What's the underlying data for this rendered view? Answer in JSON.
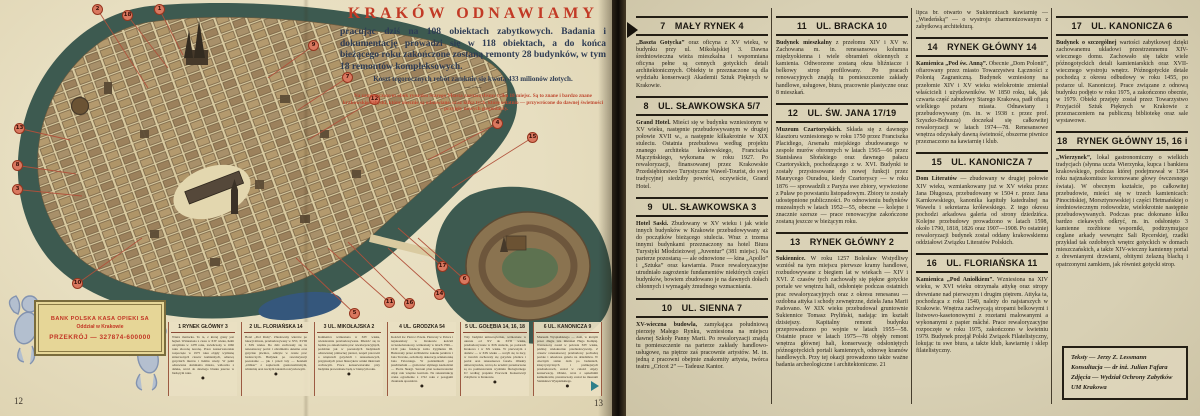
{
  "colors": {
    "accent_red": "#c23a26",
    "navy_text": "#2e3c54",
    "moat_teal": "#3d5a50",
    "paper_left": "#e7dec0",
    "paper_right": "#d8d0b4",
    "marker_red": "#d9785f"
  },
  "page_left": {
    "page_number_left": "12",
    "page_number_right": "13",
    "title_block": {
      "title": "KRAKÓW ODNAWIAMY",
      "intro": "pracując dziś na 108 obiektach zabytkowych. Badania i dokumentację prowadzi się w 118 obiektach, a do końca bieżącego roku zakończone zostaną remonty 28 budynków, w tym 18 remontów kompleksowych.",
      "cost_line": "Koszt tegorocznych robót zamknie się kwotą 433 milionów złotych.",
      "ornament": "— · —",
      "note": "Na zamieszczonym obok rysunku Starego Miasta zaznaczyliśmy tylko 18 miejsc. Są to znane i bardzo znane krakowskie zabytki, które obecnie są odnawiane, oraz kilka tych, które ostatnio — przywrócone do dawnej świetności — przyjęły nowych gospodarzy."
    },
    "stamp": {
      "line1": "BANK POLSKA KASA OPIEKI SA",
      "line2": "Oddział w Krakowie",
      "line3": "PRZEKRÓJ — 327874-600000"
    },
    "map_markers": [
      {
        "n": "1",
        "x": 154,
        "y": 4,
        "tx": 183,
        "ty": 55
      },
      {
        "n": "2",
        "x": 92,
        "y": 4,
        "tx": 148,
        "ty": 88
      },
      {
        "n": "18",
        "x": 122,
        "y": 10,
        "tx": 168,
        "ty": 68
      },
      {
        "n": "9",
        "x": 308,
        "y": 40,
        "tx": 268,
        "ty": 78
      },
      {
        "n": "7",
        "x": 342,
        "y": 72,
        "tx": 298,
        "ty": 110
      },
      {
        "n": "12",
        "x": 369,
        "y": 94,
        "tx": 308,
        "ty": 140
      },
      {
        "n": "4",
        "x": 492,
        "y": 118,
        "tx": 428,
        "ty": 160
      },
      {
        "n": "15",
        "x": 527,
        "y": 132,
        "tx": 452,
        "ty": 188
      },
      {
        "n": "13",
        "x": 14,
        "y": 123,
        "tx": 70,
        "ty": 140
      },
      {
        "n": "8",
        "x": 12,
        "y": 160,
        "tx": 76,
        "ty": 174
      },
      {
        "n": "3",
        "x": 12,
        "y": 184,
        "tx": 82,
        "ty": 196
      },
      {
        "n": "10",
        "x": 72,
        "y": 278,
        "tx": 142,
        "ty": 238
      },
      {
        "n": "5",
        "x": 349,
        "y": 308,
        "tx": 296,
        "ty": 258
      },
      {
        "n": "11",
        "x": 384,
        "y": 297,
        "tx": 328,
        "ty": 248
      },
      {
        "n": "16",
        "x": 404,
        "y": 298,
        "tx": 348,
        "ty": 242
      },
      {
        "n": "17",
        "x": 437,
        "y": 261,
        "tx": 398,
        "ty": 228
      },
      {
        "n": "6",
        "x": 459,
        "y": 274,
        "tx": 418,
        "ty": 238
      },
      {
        "n": "14",
        "x": 434,
        "y": 289,
        "tx": 388,
        "ty": 248
      }
    ],
    "bottom_boxes": [
      {
        "number": "1",
        "title": "RYNEK GŁÓWNY 3",
        "text": "Wieża mariacka. To ta, z której grany jest hejnał. Wzniesiona z ciosu w XIV wieku, hełm otrzymała w 1478 roku, zwieńczony w 1666 roku złoconą koroną. Prace konserwatorskie rozpoczęte w 1975 roku objęły wymianę zniszczonych ciosów kamiennych, odnowę gotyckich murów i hełmu wieży. W pełni odnowiona dominanta miasta, widoczna z daleka, wróci do dawnego blasku jeszcze w bieżącym roku."
      },
      {
        "number": "2",
        "title": "UL. FLORIAŃSKA 14",
        "text": "Hotel „Pod Różą”. Zbudowany wkrótce po lokacji miasta, przebudowywany w XVI, XVIII i XIX wieku. Do dziś zachowały się tu renesansowy portal i obramienia okienne oraz gotyckie piwnice, odkryte w czasie prac badawczych. Budynek po rewaloryzacji pozostanie — jak i przed laty — hotelem „Orbisu” z zapleczem gastronomicznym, winiarnią oraz nocnym lokalem rozrywkowym."
      },
      {
        "number": "3",
        "title": "UL. MIKOŁAJSKA 2",
        "text": "Kamienica wzniesiona w XIV wieku, wielokrotnie przebudowywana. Mieścić się tu będzie po zakończeniu prac rewaloryzacyjnych, podobnie jak w pozostałych budynkach odnowionej północnej pierzei, zespół pracowni o wnętrzach gotyckich i renesansowych, przypisanych przez historyków sztuki mistrzom cechowym. Prace konserwatorskie przy budynku prowadzone będą w bieżącym roku."
      },
      {
        "number": "4",
        "title": "UL. GRODZKA 54",
        "text": "Kościół św. Piotra i Pawła. Pierwszy w Polsce i najokazalszy w Krakowie kościół wczesnobarokowy, wzniesiony w latach 1596—1619 jako fundacja króla Zygmunta III. Budowany przez architektów zakonu jezuitów i Jana Trevano, ozdobiony dekoracją sztukatorską Jana Falconiego. W podziemiach pod prezbiterium — grobowiec słynnego kaznodziei — Piotra Skargi. Szeroki plan konserwatorski objął całe wnętrze kościoła. Na rekonstrukcję czeka ogrodzenie z 1722 roku z posągami dwunastu apostołów."
      },
      {
        "number": "5",
        "title": "UL. GOŁĘBIA 14, 16, 18",
        "text": "Trzy budynki uniwersyteckie, wzniesione w okresie od XV do XVII wieku, przebudowywane w XIX stuleciu, po pożarach Krakowa i w XX wieku. W pierwszym z domów — w XIX wieku — uczyli się tu żacy, w trzecim zachowały się gotyckie piwnice i portal oraz renesansowa fasada. Obiekty uniwersyteckie, wrócą do uczelni: przeznaczone są na pomieszczenia wydziału filologicznego UJ według projektu Pracowni Konserwacji Zabytków w Krakowie."
      },
      {
        "number": "6",
        "title": "UL. KANONICZA 9",
        "text": "Muzeum Wyspiańskiego — dom, w którym przez długie lata mieszkał Hugo Kołłątaj. Wzniesiony został w połowie XIV wieku, później wielokrotnie przebudowywany. Z czasów renesansowej przebudowy pochodzą portale i arkadowa galeria na dziedzińcu. W obecnym stanie dom po badaniach, klasycystycznych i późniejszych przebudowach, został w całości objęty konserwacją. Obiekt, wraz z sąsiednimi kamienicami, przeznaczony został na muzeum Stanisława Wyspiańskiego."
      }
    ]
  },
  "page_right": {
    "columns": [
      [
        {
          "h": "7",
          "t": "MAŁY RYNEK 4"
        },
        {
          "lead": "„Baszta Gotycka”",
          "p": "oraz oficyna z XV wieku, w budynku przy ul. Mikołajskiej 3. Dawna średniowieczna wieża mieszkalna i wspomniana oficyna pełne są cennych gotyckich detali architektonicznych. Obiekty te przeznaczone są dla wydziału konserwacji Akademii Sztuk Pięknych w Krakowie."
        },
        {
          "h": "8",
          "t": "UL. SŁAWKOWSKA 5/7"
        },
        {
          "lead": "Grand Hotel.",
          "p": "Mieści się w budynku wzniesionym w XV wieku, następnie przebudowywanym w drugiej połowie XVII w., a następnie kilkakrotnie w XIX stuleciu. Ostatnia przebudowa według projektu znanego architekta krakowskiego, Franciszka Mączyńskiego, wykonana w roku 1927. Po rewaloryzacji, finansowanej przez Krakowskie Przedsiębiorstwo Turystyczne Wawel-Tourist, do swej tradycyjnej siedziby powróci, oczywiście, Grand Hotel."
        },
        {
          "h": "9",
          "t": "UL. SŁAWKOWSKA 3"
        },
        {
          "lead": "Hotel Saski.",
          "p": "Zbudowany w XV wieku i jak wiele innych budynków w Krakowie przebudowywany aż do początków bieżącego stulecia. Wraz z trzema innymi budynkami przeznaczony na hotel Biura Turystyki Młodzieżowej „Juventur” (381 miejsc). Na parterze pozostaną — ale odnowione — kina „Apollo” i „Sztuka” oraz kawiarnia. Prace rewaloryzacyjne utrudniało zagrożenie fundamentów niektórych części budynków, bowiem zbudowano je na dawnych dołach chłonnych i wymagały żmudnego wzmacniania."
        },
        {
          "h": "10",
          "t": "UL. SIENNA 7"
        },
        {
          "lead": "XV-wieczna budowla,",
          "p": "zamykająca południową pierzeję Małego Rynku, wzniesiona na miejscu dawnej Szkoły Panny Marii. Po rewaloryzacji znajdą tu pomieszczenie na parterze zakłady handlowo-usługowe, na piętrze zaś pracownie artystów. M. in. jedną z pracowni obejmie znakomity artysta, twórca teatru „Cricot 2” — Tadeusz Kantor."
        }
      ],
      [
        {
          "h": "11",
          "t": "UL. BRACKA 10"
        },
        {
          "lead": "Budynek mieszkalny",
          "p": "z przełomu XIV i XV w. Zachowana m. in. renesansowa kolumna międzyokienna i wiele obramień okiennych z kamienia. Odtworzone zostaną okna bliźniacze i belkowy strop profilowany. Po pracach renowacyjnych znajdą tu pomieszczenie zakłady handlowe, usługowe, biura, pracownie plastyczne oraz 8 mieszkań."
        },
        {
          "h": "12",
          "t": "UL. ŚW. JANA 17/19"
        },
        {
          "lead": "Muzeum Czartoryskich.",
          "p": "Składa się z dawnego klasztoru wzniesionego w roku 1750 przez Franciszka Placidiego, Arsenału miejskiego zbudowanego w zespole murów obronnych w latach 1565—66 przez Stanisława Słońskiego oraz dawnego pałacu Czartoryskich, pochodzącego z w. XVI. Budynki te zostały przystosowane do nowej funkcji przez Maurycego Ouradou, kiedy Czartoryscy — w roku 1876 — sprowadzili z Paryża swe zbiory, wywiezione z Puław po powstaniu listopadowym. Zbiory te zostały udostępnione publiczności. Po odnowieniu budynków muzealnych w latach 1952—55, obecne — kolejne i znacznie szersze — prace renowacyjne zakończone zostaną jeszcze w bieżącym roku."
        },
        {
          "h": "13",
          "t": "RYNEK GŁÓWNY 2"
        },
        {
          "lead": "Sukiennice.",
          "p": "W roku 1257 Bolesław Wstydliwy wzniósł na tym miejscu pierwsze kramy handlowe, rozbudowywane z biegiem lat w wiekach — XIV i XVI. Z czasów tych zachowały się piękne gotyckie portale we wnętrzu hali, odsłonięte podczas ostatnich prac rewaloryzacyjnych oraz z okresu renesansu — ozdobna attyka i schody zewnętrzne, dzieła Jana Marii Padovano. W XIX wieku przebudował gruntownie Sukiennice Tomasz Pryliński, nadając im kształt dzisiejszy. Kapitalny remont budynku przeprowadzono po wojnie w latach 1955—58. Ostatnie prace w latach 1975—78 objęły remont wnętrza głównej hali, konserwację odsłoniętych późnogotyckich portali kamiennych, odnowę kramów handlowych. Przy tej okazji prowadzono także ważne badania archeologiczne i architektoniczne. 21"
        }
      ],
      [
        {
          "p": "lipca br. otwarto w Sukiennicach kawiarnię — „Wiedeńską” — o wystroju zharmonizowanym z zabytkową architekturą."
        },
        {
          "h": "14",
          "t": "RYNEK GŁÓWNY 14"
        },
        {
          "lead": "Kamienica „Pod św. Anną”.",
          "p": "Obecnie „Dom Polonii”, ofiarowany przez miasto Towarzystwu Łączności z Polonią Zagraniczną. Budynek wzniesiony na przełomie XIV i XV wieku wielokrotnie zmieniał właścicieli i użytkowników. W 1850 roku, tak, jak czwarta część zabudowy Starego Krakowa, padł ofiarą wielkiego pożaru miasta. Odnawiany i przebudowywany (m. in. w 1938 r. przez prof. Szyszko-Bohusza) doczekał się całkowitej rewaloryzacji w latach 1974—78. Renesansowe wnętrza odzyskały dawną świetność, obszerne piwnice przeznaczono na kawiarnię i klub."
        },
        {
          "h": "15",
          "t": "UL. KANONICZA 7"
        },
        {
          "lead": "Dom Literatów",
          "p": "— zbudowany w drugiej połowie XIV wieku, wzmiankowany już w XV wieku przez Jana Długosza, przebudowany w 1504 r. przez Jana Karnkowskiego, kanonika kapituły katedralnej na Wawelu i sekretarza królewskiego. Z tego okresu pochodzi arkadowa galeria od strony dziedzińca. Kolejne przebudowy prowadzono w latach 1598, około 1790, 1818, 1826 oraz 1907—1908. Po ostatniej rewaloryzacji budynek został oddany krakowskiemu oddziałowi Związku Literatów Polskich."
        },
        {
          "h": "16",
          "t": "UL. FLORIAŃSKA 11"
        },
        {
          "lead": "Kamienica „Pod Aniołkiem”.",
          "p": "Wzniesiona na XIV wieku, w XVI wieku otrzymała attykę oraz stropy drewniane nad pierwszym i drugim piętrem. Attyka ta, pochodząca z roku 1540, należy do najstarszych w Krakowie. Wnętrza zachwycają stropami belkowymi i listwowo-kasetonowymi z rozetami malowanymi a wykonanymi z papier mâché. Prace rewaloryzacyjne rozpoczęte w roku 1975, zakończono w kwietniu 1979. Budynek przejął Polski Związek Filatelistyczny, lokując tu swe biura, a także klub, kawiarnię i sklep filatelistyczny."
        }
      ],
      [
        {
          "h": "17",
          "t": "UL. KANONICZA 6"
        },
        {
          "lead": "Budynek o szczególnej",
          "p": "wartości zabytkowej dzięki zachowanemu układowi przestrzennemu XIV-wiecznego domu. Zachowało się także wiele późnogotyckich detali kamieniarskich oraz XVII-wiecznego wystroju wnętrz. Późnogotyckie detale pochodzą z okresu odbudowy w roku 1455, po pożarze ul. Kanoniczej. Prace związane z odnową budynku podjęto w roku 1975, a zakończono obecnie, w 1979. Obiekt przejęty został przez Towarzystwo Przyjaciół Sztuk Pięknych w Krakowie z przeznaczeniem na publiczną bibliotekę oraz sale wystawowe."
        },
        {
          "h": "18",
          "t": "RYNEK GŁÓWNY 15, 16 i 17"
        },
        {
          "lead": "„Wierzynek”,",
          "p": "lokal gastronomiczny o wielkich tradycjach (słynna uczta Wierzynka, kupca i bankiera krakowskiego, podczas której podejmował w 1364 roku najznakomitsze koronowane głowy ówczesnego świata). W obecnym kształcie, po całkowitej przebudowie, mieści się w trzech kamienicach: Pinocińskiej, Morsztynowskiej i części Hetmańskiej o średniowiecznym rodowodzie, wielokrotnie następnie przebudowywanych. Podczas prac dokonano kilku bardzo ciekawych odkryć, m. in. odsłonięto 3 kamienne rzeźbione wsporniki, podtrzymujące ceglane arkady wewnątrz Sali Rycerskiej, rzadki przykład tak ozdobnych wnętrz gotyckich w domach mieszczańskich, a także XIV-wieczny kamienny portal z drewnianymi drzwiami, obitymi żelazną blachą i opatrzonymi zamkiem, jak również gotycki strop."
        }
      ]
    ],
    "credits": [
      "Teksty — Jerzy Z. Lessmann",
      "Konsultacja — dr inż. Julian Fąfara",
      "Zdjęcia — Wydział Ochrony Zabytków UM Krakowa"
    ]
  }
}
